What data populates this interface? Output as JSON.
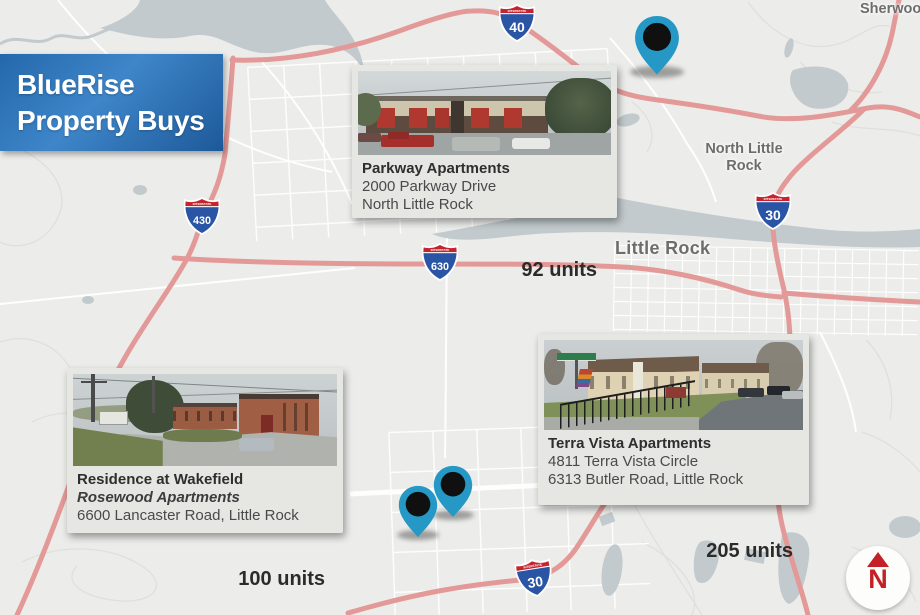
{
  "banner": {
    "title_line1": "BlueRise",
    "title_line2": "Property Buys"
  },
  "map_labels": {
    "sherwood": "Sherwood",
    "north_little_rock_line1": "North Little",
    "north_little_rock_line2": "Rock",
    "little_rock": "Little Rock"
  },
  "shields": {
    "interstate": "INTERSTATE",
    "i40": "40",
    "i430": "430",
    "i630": "630",
    "i30": "30"
  },
  "compass": {
    "letter": "N"
  },
  "cards": {
    "parkway": {
      "name": "Parkway Apartments",
      "address_line1": "2000 Parkway Drive",
      "address_line2": "North Little Rock",
      "units": "92 units"
    },
    "wakefield": {
      "name": "Residence at Wakefield",
      "alt_name": "Rosewood Apartments",
      "address_line1": "6600 Lancaster Road, Little Rock",
      "units": "100 units"
    },
    "terra_vista": {
      "name": "Terra Vista Apartments",
      "address_line1": "4811 Terra Vista Circle",
      "address_line2": "6313 Butler Road, Little Rock",
      "units": "205 units"
    }
  },
  "colors": {
    "accent_blue": "#2d74b5",
    "pin_teal": "#2598c5",
    "highway_red": "#e39997",
    "river_gray": "#c2cacd",
    "compass_red": "#c32127",
    "shield_blue": "#2a55a4",
    "shield_red": "#c5232d"
  }
}
